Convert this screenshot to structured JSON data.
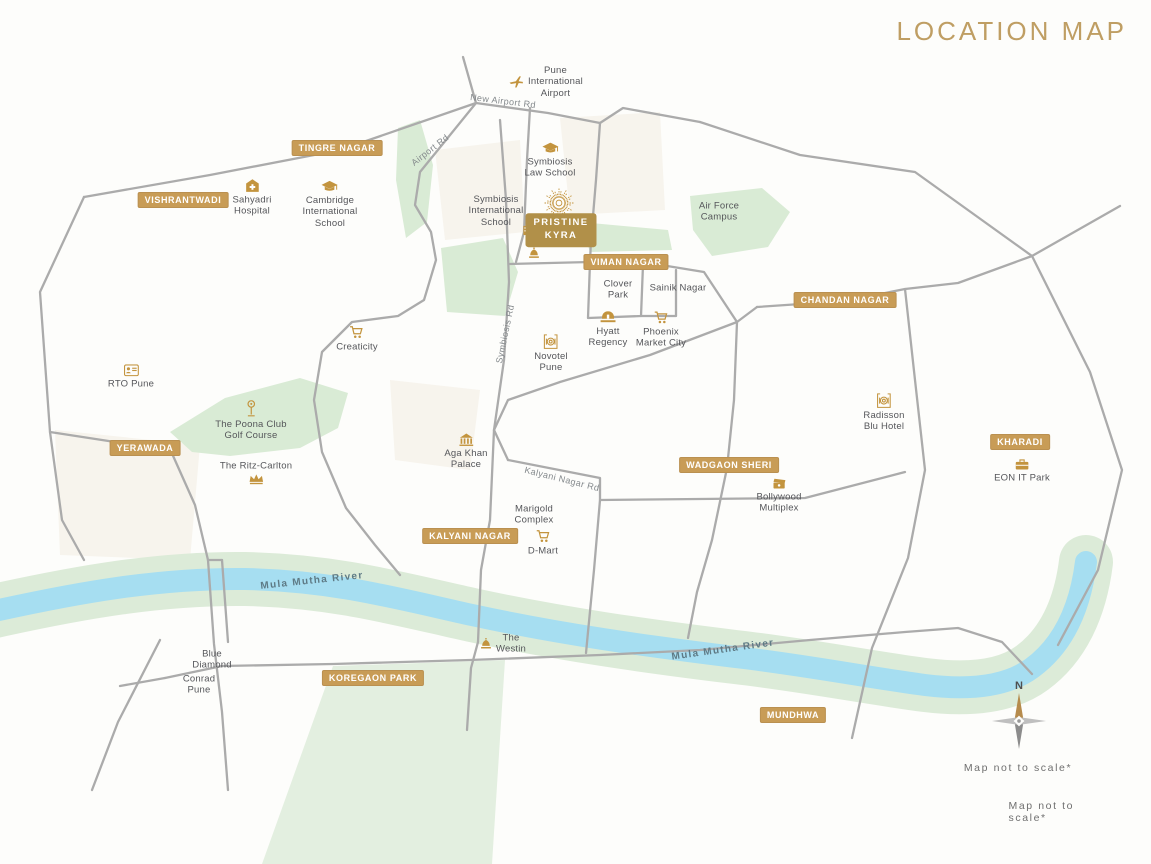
{
  "title": "LOCATION MAP",
  "notes": [
    "Map not to scale*",
    "Map not to scale*"
  ],
  "compass": {
    "north_label": "N"
  },
  "colors": {
    "accent_gold": "#bf9e63",
    "badge_gold": "#c89c56",
    "project_gold": "#b19049",
    "icon_gold": "#c3943e",
    "road_gray": "#ababab",
    "river_blue": "#a6def1",
    "river_buffer_green": "#dcebd8",
    "patch_green": "#d9ebd5",
    "label_gray": "#55565a"
  },
  "road_labels": [
    {
      "text": "New Airport Rd",
      "type": "road",
      "x": 503,
      "y": 101,
      "rotate": 7
    },
    {
      "text": "Airport Rd",
      "type": "road",
      "x": 430,
      "y": 150,
      "rotate": -38
    },
    {
      "text": "Symbiosis Rd",
      "type": "road",
      "x": 505,
      "y": 334,
      "rotate": -78
    },
    {
      "text": "Kalyani Nagar Rd",
      "type": "road",
      "x": 562,
      "y": 479,
      "rotate": 14
    },
    {
      "text": "Mula Mutha River",
      "type": "river",
      "x": 312,
      "y": 581,
      "rotate": -6
    },
    {
      "text": "Mula Mutha River",
      "type": "river",
      "x": 723,
      "y": 650,
      "rotate": -8
    }
  ],
  "badges": [
    {
      "label": "TINGRE NAGAR",
      "x": 337,
      "y": 148
    },
    {
      "label": "VISHRANTWADI",
      "x": 183,
      "y": 200
    },
    {
      "label": "YERAWADA",
      "x": 145,
      "y": 448
    },
    {
      "label": "VIMAN NAGAR",
      "x": 626,
      "y": 262
    },
    {
      "label": "CHANDAN NAGAR",
      "x": 845,
      "y": 300
    },
    {
      "label": "KHARADI",
      "x": 1020,
      "y": 442
    },
    {
      "label": "WADGAON SHERI",
      "x": 729,
      "y": 465
    },
    {
      "label": "KALYANI NAGAR",
      "x": 470,
      "y": 536
    },
    {
      "label": "KOREGAON PARK",
      "x": 373,
      "y": 678
    },
    {
      "label": "MUNDHWA",
      "x": 793,
      "y": 715
    }
  ],
  "landmarks": [
    {
      "name": "pristine-kyra-logo",
      "icon": "sunburst-logo",
      "lines": [],
      "x": 559,
      "y": 203
    },
    {
      "name": "pristine-kyra-site",
      "icon": "buildings-icon",
      "lines": [],
      "x": 529,
      "y": 228
    },
    {
      "name": "pristine-kyra",
      "style": "project",
      "lines": [
        "PRISTINE",
        "KYRA"
      ],
      "x": 561,
      "y": 230
    },
    {
      "name": "temple-dome",
      "icon": "dome-icon",
      "lines": [],
      "x": 534,
      "y": 253
    },
    {
      "name": "pune-international-airport",
      "icon": "airplane-icon",
      "icon_pos": "left",
      "lines": [
        "Pune",
        "International",
        "Airport"
      ],
      "x": 546,
      "y": 82
    },
    {
      "name": "symbiosis-law-school",
      "icon": "school-icon",
      "lines": [
        "Symbiosis",
        "Law School"
      ],
      "x": 550,
      "y": 161
    },
    {
      "name": "cambridge-international-school",
      "icon": "school-icon",
      "lines": [
        "Cambridge",
        "International",
        "School"
      ],
      "x": 330,
      "y": 205
    },
    {
      "name": "sahyadri-hospital",
      "icon": "hospital-icon",
      "lines": [
        "Sahyadri",
        "Hospital"
      ],
      "x": 252,
      "y": 198
    },
    {
      "name": "symbiosis-international-school",
      "lines": [
        "Symbiosis",
        "International",
        "School"
      ],
      "x": 496,
      "y": 211
    },
    {
      "name": "air-force-campus",
      "lines": [
        "Air Force",
        "Campus"
      ],
      "x": 719,
      "y": 212
    },
    {
      "name": "clover-park",
      "lines": [
        "Clover",
        "Park"
      ],
      "x": 618,
      "y": 290
    },
    {
      "name": "sainik-nagar",
      "lines": [
        "Sainik Nagar"
      ],
      "x": 678,
      "y": 288
    },
    {
      "name": "hyatt-regency",
      "icon": "bed-icon",
      "lines": [
        "Hyatt",
        "Regency"
      ],
      "x": 608,
      "y": 330
    },
    {
      "name": "phoenix-market-city",
      "icon": "cart-icon",
      "lines": [
        "Phoenix",
        "Market City"
      ],
      "x": 661,
      "y": 330
    },
    {
      "name": "novotel-pune",
      "icon": "plate-icon",
      "lines": [
        "Novotel",
        "Pune"
      ],
      "x": 551,
      "y": 354
    },
    {
      "name": "creaticity",
      "icon": "cart-icon",
      "lines": [
        "Creaticity"
      ],
      "x": 357,
      "y": 339
    },
    {
      "name": "rto-pune",
      "icon": "idcard-icon",
      "lines": [
        "RTO Pune"
      ],
      "x": 131,
      "y": 377
    },
    {
      "name": "the-poona-club-golf-course",
      "icon": "golf-icon",
      "lines": [
        "The Poona Club",
        "Golf Course"
      ],
      "x": 251,
      "y": 421
    },
    {
      "name": "the-ritz-carlton",
      "icon": "crown-icon",
      "icon_pos": "below",
      "lines": [
        "The Ritz-Carlton"
      ],
      "x": 256,
      "y": 473
    },
    {
      "name": "aga-khan-palace",
      "icon": "palace-icon",
      "lines": [
        "Aga Khan",
        "Palace"
      ],
      "x": 466,
      "y": 452
    },
    {
      "name": "marigold-complex",
      "lines": [
        "Marigold",
        "Complex"
      ],
      "x": 534,
      "y": 515
    },
    {
      "name": "d-mart",
      "icon": "cart-icon",
      "lines": [
        "D-Mart"
      ],
      "x": 543,
      "y": 543
    },
    {
      "name": "radisson-blu-hotel",
      "icon": "plate-icon",
      "lines": [
        "Radisson",
        "Blu Hotel"
      ],
      "x": 884,
      "y": 413
    },
    {
      "name": "eon-it-park",
      "icon": "briefcase-icon",
      "lines": [
        "EON IT Park"
      ],
      "x": 1022,
      "y": 471
    },
    {
      "name": "bollywood-multiplex",
      "icon": "clapper-icon",
      "lines": [
        "Bollywood",
        "Multiplex"
      ],
      "x": 779,
      "y": 496
    },
    {
      "name": "the-westin",
      "icon": "dome-icon",
      "icon_pos": "left",
      "lines": [
        "The",
        "Westin"
      ],
      "x": 503,
      "y": 644
    },
    {
      "name": "blue-diamond",
      "lines": [
        "Blue",
        "Diamond"
      ],
      "x": 212,
      "y": 660
    },
    {
      "name": "conrad-pune",
      "lines": [
        "Conrad",
        "Pune"
      ],
      "x": 199,
      "y": 685
    }
  ]
}
